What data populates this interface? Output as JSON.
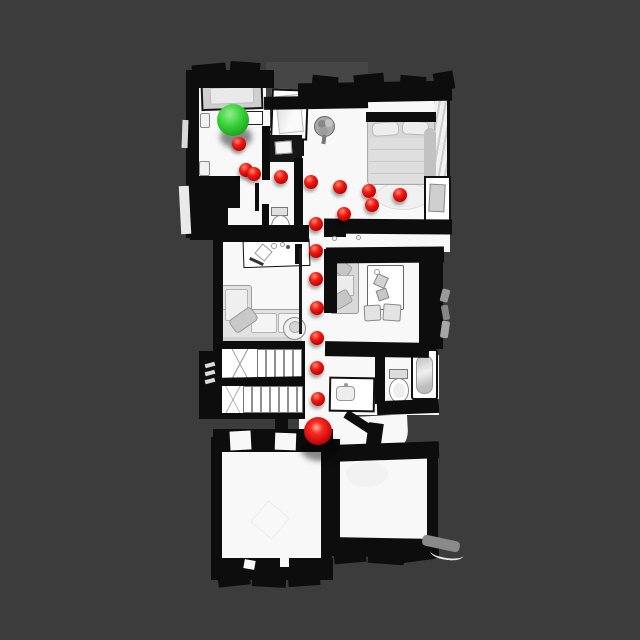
{
  "scene": {
    "kind": "top-down rendered house scan with navigation path",
    "background_color": "#3c3c3c",
    "floor_color": "#f8f8f8",
    "wall_color": "#0d0d0d",
    "canvas": {
      "width": 640,
      "height": 640
    }
  },
  "markers": {
    "goal": {
      "icon": "goal-sphere",
      "color": "#2ecc2e",
      "x": 233,
      "y": 120,
      "radius": 16
    },
    "start": {
      "icon": "start-sphere",
      "color": "#dd1111",
      "x": 318,
      "y": 431,
      "radius": 14
    }
  },
  "path": {
    "dot_color": "#dd1111",
    "dot_radius": 7,
    "waypoints": [
      [
        239,
        144
      ],
      [
        246,
        170
      ],
      [
        254,
        174
      ],
      [
        281,
        177
      ],
      [
        311,
        182
      ],
      [
        340,
        187
      ],
      [
        369,
        191
      ],
      [
        400,
        195
      ],
      [
        372,
        205
      ],
      [
        344,
        214
      ],
      [
        316,
        224
      ],
      [
        316,
        251
      ],
      [
        316,
        279
      ],
      [
        317,
        308
      ],
      [
        317,
        338
      ],
      [
        317,
        368
      ],
      [
        318,
        399
      ]
    ]
  },
  "rooms": [
    "top-left-bedroom",
    "half-bath",
    "top-right-bedroom",
    "living-room",
    "middle-bedroom",
    "bathroom",
    "staircase",
    "hallway",
    "entry-landing",
    "bottom-left-room",
    "bottom-right-room"
  ]
}
